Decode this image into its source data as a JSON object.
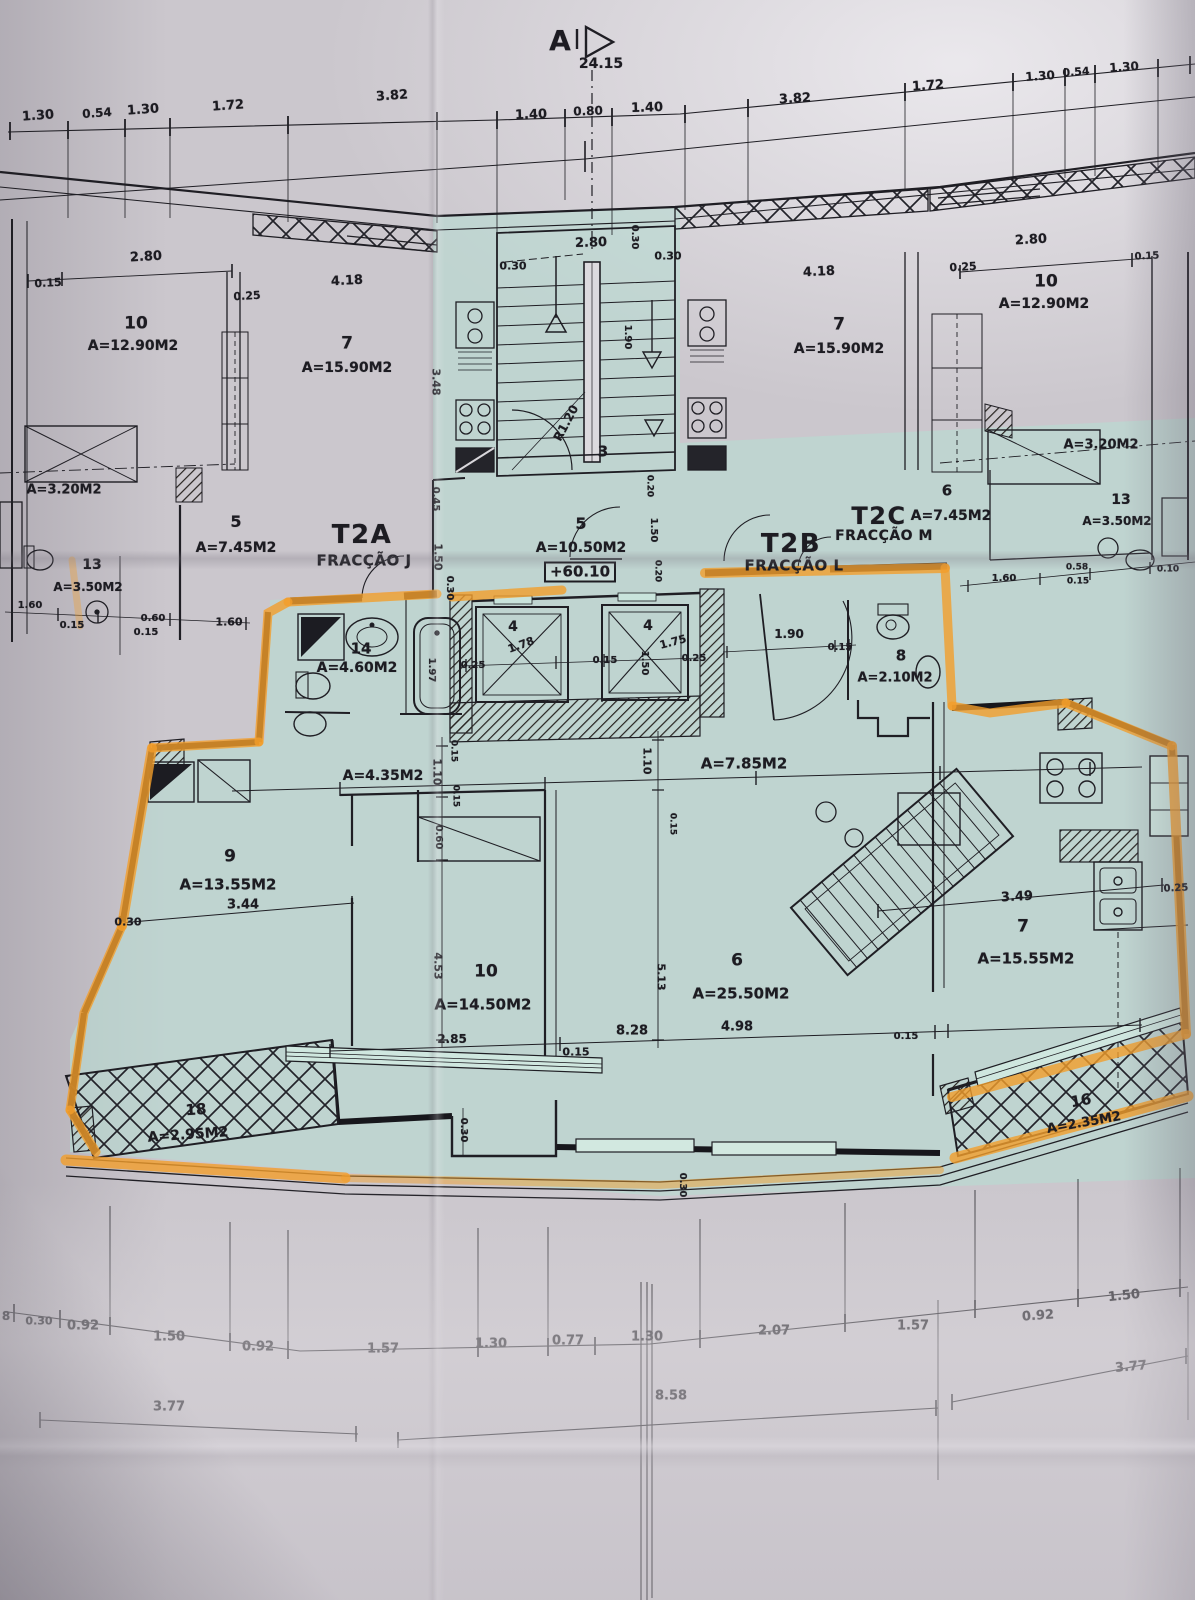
{
  "drawing": {
    "section_marker": "A",
    "overall_dimension": "24.15",
    "level_mark": "+60.10",
    "units": [
      {
        "code": "T2A",
        "fraction": "FRACÇÃO J"
      },
      {
        "code": "T2B",
        "fraction": "FRACÇÃO L"
      },
      {
        "code": "T2C",
        "fraction": "FRACÇÃO M"
      }
    ],
    "colors": {
      "paper": "#cbc7cd",
      "teal_wash": "#b7dcd2",
      "highlighter": "#f2a02c",
      "ink": "#1d1c22"
    }
  },
  "annotations": [
    {
      "k": "mark",
      "t": "A",
      "x": 560,
      "y": 41,
      "s": 28
    },
    {
      "k": "dim",
      "t": "24.15",
      "x": 601,
      "y": 64,
      "s": 14
    },
    {
      "k": "dim",
      "t": "1.30",
      "x": 38,
      "y": 116,
      "s": 13,
      "r": -4
    },
    {
      "k": "dim",
      "t": "0.54",
      "x": 97,
      "y": 113,
      "s": 12,
      "r": -4
    },
    {
      "k": "dim",
      "t": "1.30",
      "x": 143,
      "y": 110,
      "s": 13,
      "r": -4
    },
    {
      "k": "dim",
      "t": "1.72",
      "x": 228,
      "y": 106,
      "s": 13,
      "r": -4
    },
    {
      "k": "dim",
      "t": "3.82",
      "x": 392,
      "y": 96,
      "s": 13,
      "r": -4
    },
    {
      "k": "dim",
      "t": "1.40",
      "x": 531,
      "y": 115,
      "s": 13,
      "r": -2
    },
    {
      "k": "dim",
      "t": "0.80",
      "x": 588,
      "y": 111,
      "s": 12,
      "r": -2
    },
    {
      "k": "dim",
      "t": "1.40",
      "x": 647,
      "y": 108,
      "s": 13,
      "r": -2
    },
    {
      "k": "dim",
      "t": "3.82",
      "x": 795,
      "y": 99,
      "s": 13,
      "r": -3
    },
    {
      "k": "dim",
      "t": "1.72",
      "x": 928,
      "y": 86,
      "s": 13,
      "r": -4
    },
    {
      "k": "dim",
      "t": "1.30",
      "x": 1040,
      "y": 76,
      "s": 12,
      "r": -4
    },
    {
      "k": "dim",
      "t": "0.54",
      "x": 1076,
      "y": 72,
      "s": 11,
      "r": -4
    },
    {
      "k": "dim",
      "t": "1.30",
      "x": 1124,
      "y": 67,
      "s": 12,
      "r": -4
    },
    {
      "k": "dim",
      "t": "0.15",
      "x": 48,
      "y": 283,
      "s": 11,
      "r": -3
    },
    {
      "k": "dim",
      "t": "2.80",
      "x": 146,
      "y": 257,
      "s": 13,
      "r": -3
    },
    {
      "k": "room",
      "t": "10",
      "x": 136,
      "y": 324,
      "s": 17
    },
    {
      "k": "area",
      "t": "A=12.90M2",
      "x": 133,
      "y": 346,
      "s": 14
    },
    {
      "k": "dim",
      "t": "0.25",
      "x": 247,
      "y": 296,
      "s": 11,
      "r": -3
    },
    {
      "k": "dim",
      "t": "4.18",
      "x": 347,
      "y": 281,
      "s": 13,
      "r": -3
    },
    {
      "k": "room",
      "t": "7",
      "x": 347,
      "y": 344,
      "s": 17
    },
    {
      "k": "area",
      "t": "A=15.90M2",
      "x": 347,
      "y": 368,
      "s": 14
    },
    {
      "k": "dim",
      "t": "3.48",
      "x": 436,
      "y": 382,
      "s": 11,
      "r": 90
    },
    {
      "k": "area",
      "t": "A=3.20M2",
      "x": 64,
      "y": 490,
      "s": 13
    },
    {
      "k": "room",
      "t": "5",
      "x": 236,
      "y": 522,
      "s": 16
    },
    {
      "k": "area",
      "t": "A=7.45M2",
      "x": 236,
      "y": 548,
      "s": 14
    },
    {
      "k": "room",
      "t": "13",
      "x": 92,
      "y": 565,
      "s": 14
    },
    {
      "k": "area",
      "t": "A=3.50M2",
      "x": 88,
      "y": 587,
      "s": 12
    },
    {
      "k": "dim",
      "t": "1.60",
      "x": 30,
      "y": 606,
      "s": 10
    },
    {
      "k": "dim",
      "t": "0.15",
      "x": 72,
      "y": 626,
      "s": 10
    },
    {
      "k": "dim",
      "t": "0.60",
      "x": 153,
      "y": 619,
      "s": 10
    },
    {
      "k": "dim",
      "t": "0.15",
      "x": 146,
      "y": 633,
      "s": 10
    },
    {
      "k": "dim",
      "t": "1.60",
      "x": 229,
      "y": 622,
      "s": 11
    },
    {
      "k": "unit",
      "t": "T2A",
      "x": 362,
      "y": 535,
      "s": 26
    },
    {
      "k": "fraction",
      "t": "FRACÇÃO J",
      "x": 364,
      "y": 561,
      "s": 15
    },
    {
      "k": "dim",
      "t": "0.45",
      "x": 435,
      "y": 499,
      "s": 10,
      "r": 90
    },
    {
      "k": "dim",
      "t": "1.50",
      "x": 438,
      "y": 557,
      "s": 11,
      "r": 90
    },
    {
      "k": "dim",
      "t": "0.30",
      "x": 449,
      "y": 588,
      "s": 10,
      "r": 90
    },
    {
      "k": "dim",
      "t": "2.80",
      "x": 591,
      "y": 243,
      "s": 13,
      "r": -2
    },
    {
      "k": "dim",
      "t": "0.30",
      "x": 513,
      "y": 266,
      "s": 11
    },
    {
      "k": "dim",
      "t": "0.30",
      "x": 634,
      "y": 237,
      "s": 10,
      "r": 90
    },
    {
      "k": "dim",
      "t": "0.30",
      "x": 668,
      "y": 256,
      "s": 11
    },
    {
      "k": "dim",
      "t": "1.90",
      "x": 627,
      "y": 337,
      "s": 10,
      "r": 90
    },
    {
      "k": "dim",
      "t": "R1.20",
      "x": 566,
      "y": 423,
      "s": 12,
      "r": -62
    },
    {
      "k": "room",
      "t": "3",
      "x": 603,
      "y": 452,
      "s": 15
    },
    {
      "k": "room",
      "t": "5",
      "x": 581,
      "y": 524,
      "s": 16
    },
    {
      "k": "area",
      "t": "A=10.50M2",
      "x": 581,
      "y": 548,
      "s": 14
    },
    {
      "k": "level",
      "t": "+60.10",
      "x": 580,
      "y": 572,
      "s": 15
    },
    {
      "k": "dim",
      "t": "0.20",
      "x": 649,
      "y": 486,
      "s": 9,
      "r": 90
    },
    {
      "k": "dim",
      "t": "1.50",
      "x": 653,
      "y": 530,
      "s": 10,
      "r": 90
    },
    {
      "k": "dim",
      "t": "0.20",
      "x": 657,
      "y": 571,
      "s": 9,
      "r": 90
    },
    {
      "k": "dim",
      "t": "2.80",
      "x": 1031,
      "y": 240,
      "s": 13,
      "r": -3
    },
    {
      "k": "dim",
      "t": "0.15",
      "x": 1147,
      "y": 257,
      "s": 10,
      "r": -3
    },
    {
      "k": "dim",
      "t": "0.25",
      "x": 963,
      "y": 267,
      "s": 11,
      "r": -3
    },
    {
      "k": "dim",
      "t": "4.18",
      "x": 819,
      "y": 272,
      "s": 13,
      "r": -3
    },
    {
      "k": "room",
      "t": "7",
      "x": 839,
      "y": 325,
      "s": 17
    },
    {
      "k": "area",
      "t": "A=15.90M2",
      "x": 839,
      "y": 349,
      "s": 14
    },
    {
      "k": "room",
      "t": "10",
      "x": 1046,
      "y": 282,
      "s": 17
    },
    {
      "k": "area",
      "t": "A=12.90M2",
      "x": 1044,
      "y": 304,
      "s": 14
    },
    {
      "k": "area",
      "t": "A=3.20M2",
      "x": 1101,
      "y": 445,
      "s": 13
    },
    {
      "k": "room",
      "t": "6",
      "x": 947,
      "y": 491,
      "s": 15
    },
    {
      "k": "area",
      "t": "A=7.45M2",
      "x": 951,
      "y": 516,
      "s": 14
    },
    {
      "k": "unit",
      "t": "T2C",
      "x": 879,
      "y": 516,
      "s": 24
    },
    {
      "k": "fraction",
      "t": "FRACÇÃO M",
      "x": 884,
      "y": 536,
      "s": 14
    },
    {
      "k": "unit",
      "t": "T2B",
      "x": 791,
      "y": 544,
      "s": 26
    },
    {
      "k": "fraction",
      "t": "FRACÇÃO L",
      "x": 794,
      "y": 566,
      "s": 15
    },
    {
      "k": "room",
      "t": "13",
      "x": 1121,
      "y": 500,
      "s": 14
    },
    {
      "k": "area",
      "t": "A=3.50M2",
      "x": 1117,
      "y": 521,
      "s": 12
    },
    {
      "k": "dim",
      "t": "1.60",
      "x": 1004,
      "y": 579,
      "s": 10
    },
    {
      "k": "dim",
      "t": "0.58",
      "x": 1077,
      "y": 568,
      "s": 9
    },
    {
      "k": "dim",
      "t": "0.15",
      "x": 1078,
      "y": 582,
      "s": 9
    },
    {
      "k": "dim",
      "t": "0.10",
      "x": 1168,
      "y": 570,
      "s": 9
    },
    {
      "k": "room",
      "t": "14",
      "x": 361,
      "y": 649,
      "s": 15
    },
    {
      "k": "area",
      "t": "A=4.60M2",
      "x": 357,
      "y": 668,
      "s": 14
    },
    {
      "k": "dim",
      "t": "1.97",
      "x": 431,
      "y": 670,
      "s": 10,
      "r": 90
    },
    {
      "k": "dim",
      "t": "0.25",
      "x": 473,
      "y": 666,
      "s": 10
    },
    {
      "k": "room",
      "t": "4",
      "x": 513,
      "y": 627,
      "s": 14
    },
    {
      "k": "dim",
      "t": "1.78",
      "x": 521,
      "y": 645,
      "s": 11,
      "r": -20
    },
    {
      "k": "dim",
      "t": "0.15",
      "x": 605,
      "y": 661,
      "s": 10
    },
    {
      "k": "dim",
      "t": "1.50",
      "x": 644,
      "y": 663,
      "s": 10,
      "r": 90
    },
    {
      "k": "room",
      "t": "4",
      "x": 648,
      "y": 626,
      "s": 14
    },
    {
      "k": "dim",
      "t": "1.75",
      "x": 673,
      "y": 642,
      "s": 11,
      "r": -15
    },
    {
      "k": "dim",
      "t": "0.25",
      "x": 694,
      "y": 659,
      "s": 10
    },
    {
      "k": "dim",
      "t": "1.90",
      "x": 789,
      "y": 634,
      "s": 12
    },
    {
      "k": "dim",
      "t": "0.15",
      "x": 840,
      "y": 648,
      "s": 10
    },
    {
      "k": "room",
      "t": "8",
      "x": 901,
      "y": 656,
      "s": 15
    },
    {
      "k": "area",
      "t": "A=2.10M2",
      "x": 895,
      "y": 678,
      "s": 13
    },
    {
      "k": "area",
      "t": "A=4.35M2",
      "x": 383,
      "y": 776,
      "s": 14
    },
    {
      "k": "dim",
      "t": "1.10",
      "x": 437,
      "y": 772,
      "s": 11,
      "r": 90
    },
    {
      "k": "dim",
      "t": "0.15",
      "x": 453,
      "y": 751,
      "s": 9,
      "r": 90
    },
    {
      "k": "dim",
      "t": "0.15",
      "x": 455,
      "y": 796,
      "s": 9,
      "r": 90
    },
    {
      "k": "dim",
      "t": "0.60",
      "x": 438,
      "y": 837,
      "s": 10,
      "r": 90
    },
    {
      "k": "dim",
      "t": "1.10",
      "x": 647,
      "y": 761,
      "s": 11,
      "r": 90
    },
    {
      "k": "area",
      "t": "A=7.85M2",
      "x": 744,
      "y": 764,
      "s": 15
    },
    {
      "k": "dim",
      "t": "0.15",
      "x": 672,
      "y": 824,
      "s": 9,
      "r": 90
    },
    {
      "k": "room",
      "t": "9",
      "x": 230,
      "y": 857,
      "s": 17
    },
    {
      "k": "area",
      "t": "A=13.55M2",
      "x": 228,
      "y": 885,
      "s": 15
    },
    {
      "k": "dim",
      "t": "3.44",
      "x": 243,
      "y": 905,
      "s": 13
    },
    {
      "k": "dim",
      "t": "0.30",
      "x": 128,
      "y": 922,
      "s": 11
    },
    {
      "k": "dim",
      "t": "4.53",
      "x": 438,
      "y": 966,
      "s": 11,
      "r": 90
    },
    {
      "k": "room",
      "t": "10",
      "x": 486,
      "y": 972,
      "s": 17
    },
    {
      "k": "area",
      "t": "A=14.50M2",
      "x": 483,
      "y": 1005,
      "s": 15
    },
    {
      "k": "dim",
      "t": "2.85",
      "x": 452,
      "y": 1039,
      "s": 12
    },
    {
      "k": "dim",
      "t": "0.15",
      "x": 576,
      "y": 1052,
      "s": 11
    },
    {
      "k": "dim",
      "t": "8.28",
      "x": 632,
      "y": 1031,
      "s": 13
    },
    {
      "k": "dim",
      "t": "5.13",
      "x": 661,
      "y": 977,
      "s": 11,
      "r": 90
    },
    {
      "k": "room",
      "t": "6",
      "x": 737,
      "y": 961,
      "s": 17
    },
    {
      "k": "area",
      "t": "A=25.50M2",
      "x": 741,
      "y": 994,
      "s": 15
    },
    {
      "k": "dim",
      "t": "4.98",
      "x": 737,
      "y": 1027,
      "s": 13
    },
    {
      "k": "dim",
      "t": "3.49",
      "x": 1017,
      "y": 897,
      "s": 13,
      "r": -3
    },
    {
      "k": "room",
      "t": "7",
      "x": 1023,
      "y": 927,
      "s": 17
    },
    {
      "k": "area",
      "t": "A=15.55M2",
      "x": 1026,
      "y": 959,
      "s": 15
    },
    {
      "k": "dim",
      "t": "0.25",
      "x": 1176,
      "y": 889,
      "s": 10,
      "r": -3
    },
    {
      "k": "dim",
      "t": "0.15",
      "x": 906,
      "y": 1037,
      "s": 10
    },
    {
      "k": "room",
      "t": "18",
      "x": 196,
      "y": 1110,
      "s": 15,
      "r": -4
    },
    {
      "k": "area",
      "t": "A=2.95M2",
      "x": 188,
      "y": 1135,
      "s": 14,
      "r": -4
    },
    {
      "k": "room",
      "t": "16",
      "x": 1081,
      "y": 1101,
      "s": 15,
      "r": -10
    },
    {
      "k": "area",
      "t": "A=2.35M2",
      "x": 1084,
      "y": 1123,
      "s": 13,
      "r": -10
    },
    {
      "k": "dim",
      "t": "0.30",
      "x": 463,
      "y": 1130,
      "s": 10,
      "r": 90
    },
    {
      "k": "dim",
      "t": "0.30",
      "x": 682,
      "y": 1185,
      "s": 10,
      "r": 90
    },
    {
      "k": "dim",
      "t": "8",
      "x": 6,
      "y": 1316,
      "s": 12
    },
    {
      "k": "dim",
      "t": "0.30",
      "x": 39,
      "y": 1321,
      "s": 11
    },
    {
      "k": "dim",
      "t": "0.92",
      "x": 83,
      "y": 1326,
      "s": 13
    },
    {
      "k": "dim",
      "t": "1.50",
      "x": 169,
      "y": 1337,
      "s": 13
    },
    {
      "k": "dim",
      "t": "0.92",
      "x": 258,
      "y": 1347,
      "s": 13
    },
    {
      "k": "dim",
      "t": "1.57",
      "x": 383,
      "y": 1349,
      "s": 13
    },
    {
      "k": "dim",
      "t": "1.30",
      "x": 491,
      "y": 1344,
      "s": 13
    },
    {
      "k": "dim",
      "t": "0.77",
      "x": 568,
      "y": 1341,
      "s": 13
    },
    {
      "k": "dim",
      "t": "1.30",
      "x": 647,
      "y": 1337,
      "s": 13
    },
    {
      "k": "dim",
      "t": "2.07",
      "x": 774,
      "y": 1331,
      "s": 13
    },
    {
      "k": "dim",
      "t": "1.57",
      "x": 913,
      "y": 1326,
      "s": 13
    },
    {
      "k": "dim",
      "t": "0.92",
      "x": 1038,
      "y": 1316,
      "s": 13,
      "r": -4
    },
    {
      "k": "dim",
      "t": "1.50",
      "x": 1124,
      "y": 1296,
      "s": 13,
      "r": -6
    },
    {
      "k": "dim",
      "t": "3.77",
      "x": 169,
      "y": 1407,
      "s": 13
    },
    {
      "k": "dim",
      "t": "8.58",
      "x": 671,
      "y": 1396,
      "s": 13
    },
    {
      "k": "dim",
      "t": "3.77",
      "x": 1131,
      "y": 1367,
      "s": 13,
      "r": -5
    }
  ]
}
